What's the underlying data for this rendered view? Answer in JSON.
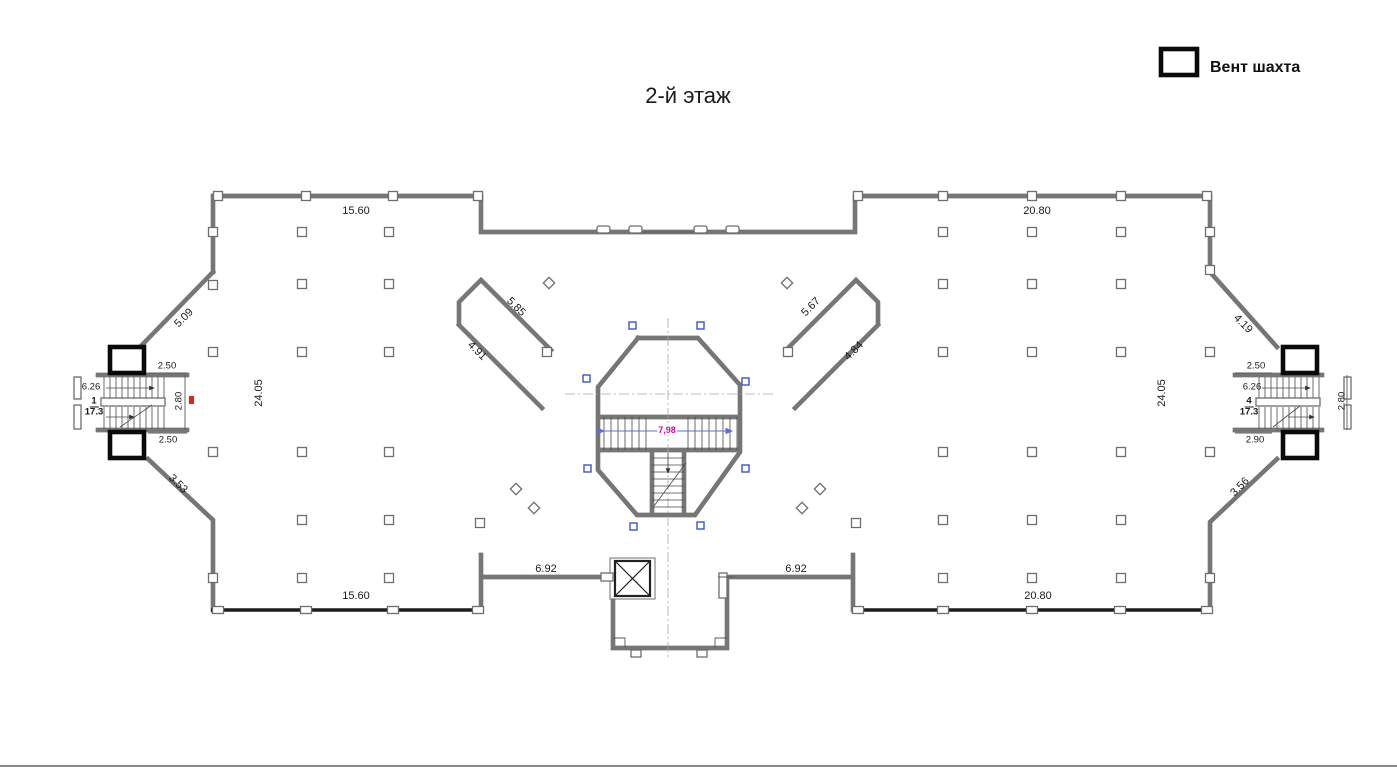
{
  "title": "2-й этаж",
  "legend": {
    "label": "Вент шахта"
  },
  "dims": {
    "top_left": "15.60",
    "top_right": "20.80",
    "bottom_left": "15.60",
    "bottom_right": "20.80",
    "left_depth": "24.05",
    "right_depth": "24.05",
    "left_diag_upper": "5.09",
    "left_diag_lower": "3.53",
    "right_diag_upper": "4.19",
    "right_diag_lower": "3.56",
    "atrium_left_upper": "5.85",
    "atrium_left_lower": "4.91",
    "atrium_right_upper": "5.67",
    "atrium_right_lower": "4.84",
    "bottom_center_left": "6.92",
    "bottom_center_right": "6.92",
    "central_stair_width": "7,98"
  },
  "left_stair": {
    "width_top": "2.50",
    "width_bottom": "2.50",
    "length": "6.26",
    "depth": "2.80",
    "room_number": "1",
    "room_area": "17.3"
  },
  "right_stair": {
    "width_top": "2.50",
    "width_bottom": "2.90",
    "length": "6.26",
    "depth": "2.80",
    "room_number": "4",
    "room_area": "17.3"
  },
  "colors": {
    "wall_gray": "#767676",
    "wall_dark": "#1c1c1c",
    "vent_black": "#0a0a0a",
    "marker_blue": "#3a56c4",
    "dim_magenta": "#cf0aa0",
    "tick_red": "#e0251b"
  }
}
